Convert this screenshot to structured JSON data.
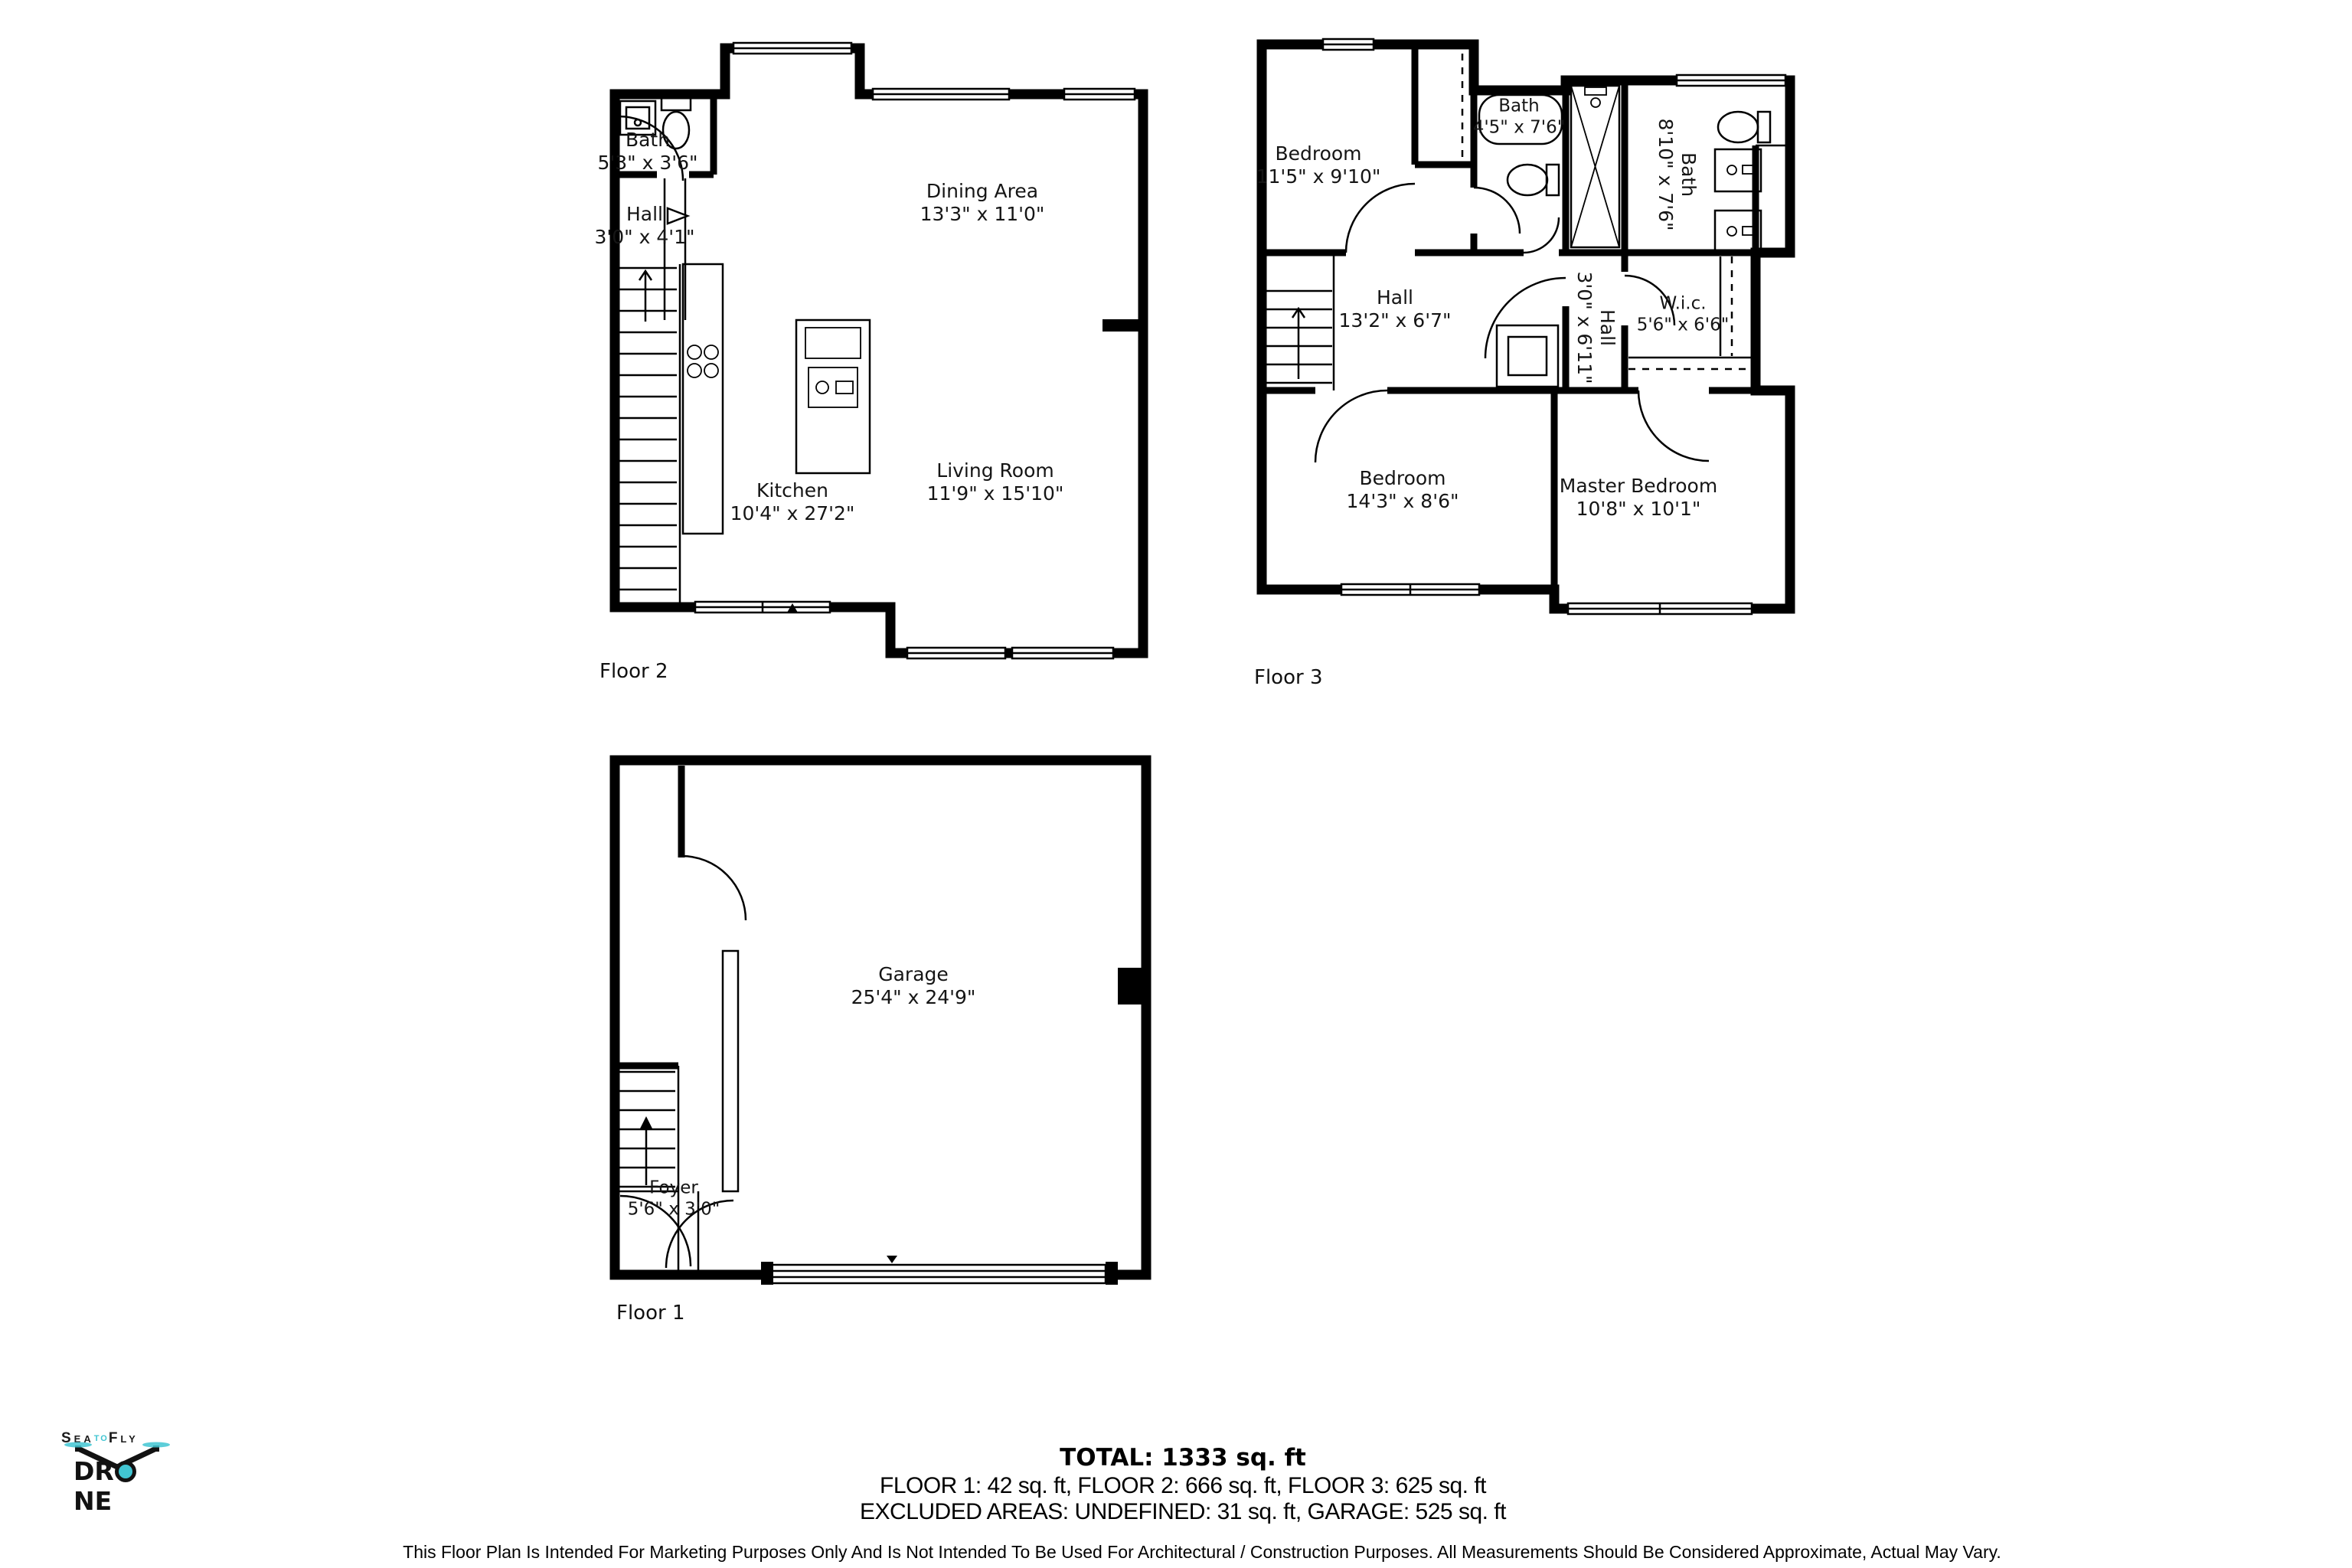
{
  "floors": {
    "floor2": {
      "label": "Floor 2",
      "rooms": {
        "bath": {
          "name": "Bath",
          "dims": "5'3\" x 3'6\""
        },
        "hall": {
          "name": "Hall",
          "dims": "3'0\" x 4'1\""
        },
        "dining": {
          "name": "Dining Area",
          "dims": "13'3\" x 11'0\""
        },
        "kitchen": {
          "name": "Kitchen",
          "dims": "10'4\" x 27'2\""
        },
        "living": {
          "name": "Living Room",
          "dims": "11'9\" x 15'10\""
        }
      }
    },
    "floor3": {
      "label": "Floor 3",
      "rooms": {
        "bedroom1": {
          "name": "Bedroom",
          "dims": "11'5\" x 9'10\""
        },
        "bath1": {
          "name": "Bath",
          "dims": "4'5\" x 7'6\""
        },
        "bath2": {
          "name": "Bath",
          "dims": "8'10\" x 7'6\""
        },
        "hall1": {
          "name": "Hall",
          "dims": "13'2\" x 6'7\""
        },
        "hall2": {
          "name": "Hall",
          "dims": "3'0\" x 6'11\""
        },
        "wic": {
          "name": "W.i.c.",
          "dims": "5'6\" x 6'6\""
        },
        "bedroom2": {
          "name": "Bedroom",
          "dims": "14'3\" x 8'6\""
        },
        "master": {
          "name": "Master Bedroom",
          "dims": "10'8\" x 10'1\""
        }
      }
    },
    "floor1": {
      "label": "Floor 1",
      "rooms": {
        "garage": {
          "name": "Garage",
          "dims": "25'4\" x 24'9\""
        },
        "foyer": {
          "name": "Foyer",
          "dims": "5'6\" x 3'0\""
        }
      }
    }
  },
  "summary": {
    "total": "TOTAL: 1333 sq. ft",
    "floors_line": "FLOOR 1: 42 sq. ft, FLOOR 2: 666 sq. ft, FLOOR 3: 625 sq. ft",
    "excluded_line": "EXCLUDED AREAS: UNDEFINED: 31 sq. ft, GARAGE: 525 sq. ft"
  },
  "disclaimer": "This Floor Plan Is Intended For Marketing Purposes Only And Is Not Intended To Be Used For Architectural / Construction Purposes. All Measurements Should Be Considered Approximate, Actual May Vary.",
  "logo": {
    "sea": "Sea",
    "to": "to",
    "fly": "Fly",
    "drone_prefix": "DR",
    "drone_suffix": "NE",
    "accent": "#41c5d2"
  }
}
